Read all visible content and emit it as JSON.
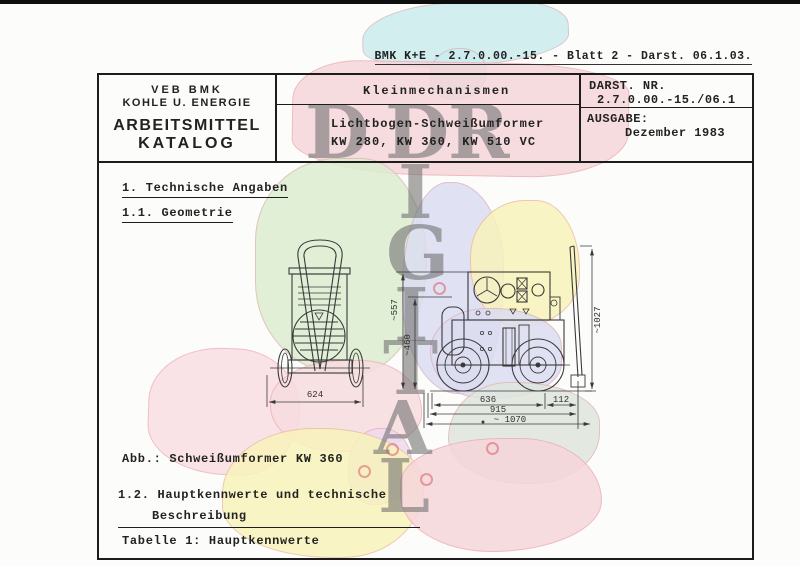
{
  "doc": {
    "top_ref": "BMK K+E - 2.7.0.00.-15. - Blatt 2 - Darst. 06.1.03.",
    "org_line1": "VEB BMK",
    "org_line2": "KOHLE U. ENERGIE",
    "catalog_line1": "ARBEITSMITTEL",
    "catalog_line2": "KATALOG",
    "category": "Kleinmechanismen",
    "product_line1": "Lichtbogen-Schweißumformer",
    "product_line2": "KW 280, KW 360, KW 510 VC",
    "darst_label": "DARST. NR.",
    "darst_value": "2.7.0.00.-15./06.1",
    "ausgabe_label": "AUSGABE:",
    "ausgabe_value": "Dezember 1983"
  },
  "body": {
    "section1": "1. Technische Angaben",
    "section11": "1.1. Geometrie",
    "figure_caption": "Abb.: Schweißumformer KW 360",
    "section12_line1": "1.2. Hauptkennwerte und technische",
    "section12_line2": "Beschreibung",
    "table_caption": "Tabelle 1: Hauptkennwerte"
  },
  "drawing": {
    "dim_front_width": "624",
    "dim_side_body": "636",
    "dim_side_rear": "112",
    "dim_side_frame": "915",
    "dim_side_overall": "~ 1070",
    "dim_height_overall": "~557",
    "dim_height_body": "~460",
    "dim_height_handle": "~1027"
  },
  "watermark": {
    "h_letters": [
      "D",
      "D",
      "R"
    ],
    "v_letters": [
      "I",
      "G",
      "I",
      "T",
      "A",
      "L"
    ]
  },
  "colors": {
    "map_cyan": "#cdeced",
    "map_pink": "#f6d6db",
    "map_green": "#dcedd0",
    "map_yellow": "#f8f3bb",
    "map_lavender": "#dcddf1",
    "map_peach": "#f9dfe3",
    "map_gray_green": "#dfe6dd",
    "map_lilac": "#eed9f0",
    "watermark_gray": "#6e6e6e",
    "ink": "#1e1e1e"
  }
}
